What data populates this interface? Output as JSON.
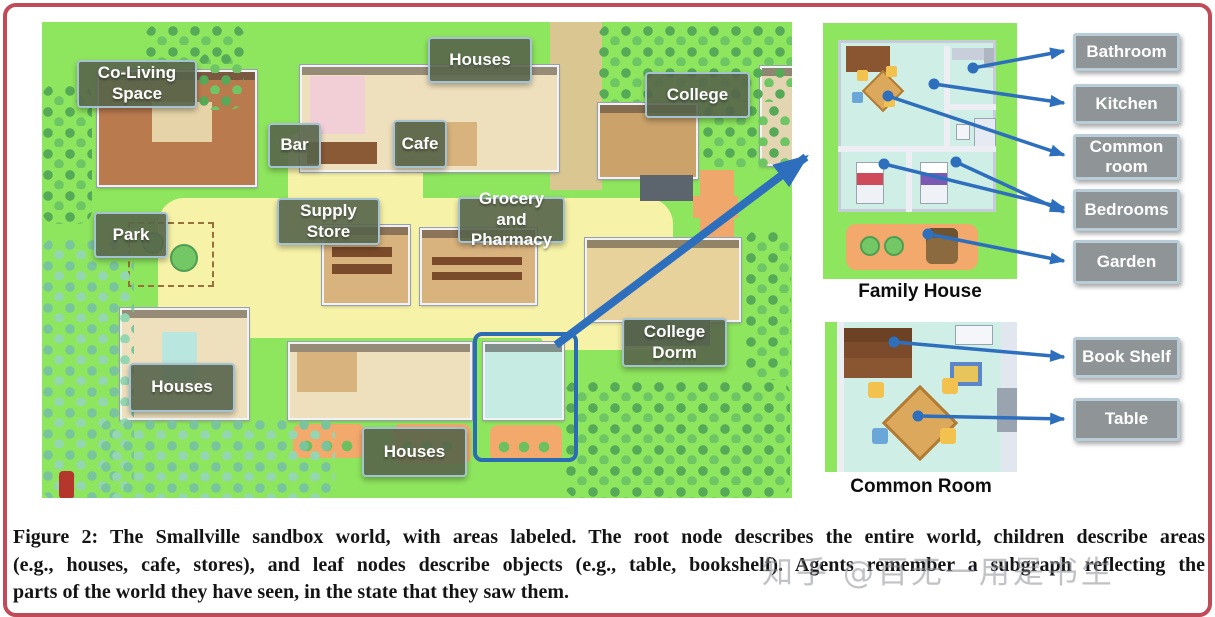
{
  "figure": {
    "caption_lines": [
      "Figure 2: The Smallville sandbox world, with areas labeled. The root node describes the entire world, children describe areas",
      "(e.g., houses, cafe, stores), and leaf nodes describe objects (e.g., table, bookshelf). Agents remember a subgraph reflecting the",
      "parts of the world they have seen, in the state that they saw them."
    ],
    "watermark": "知乎 @百无一用是书生"
  },
  "map": {
    "labels": [
      {
        "id": "co-living-space",
        "text": "Co-Living Space"
      },
      {
        "id": "houses-top",
        "text": "Houses"
      },
      {
        "id": "bar",
        "text": "Bar"
      },
      {
        "id": "cafe",
        "text": "Cafe"
      },
      {
        "id": "college",
        "text": "College"
      },
      {
        "id": "park",
        "text": "Park"
      },
      {
        "id": "supply-store",
        "text": "Supply Store"
      },
      {
        "id": "grocery-pharmacy",
        "text": "Grocery and Pharmacy"
      },
      {
        "id": "college-dorm",
        "text": "College Dorm"
      },
      {
        "id": "houses-left",
        "text": "Houses"
      },
      {
        "id": "houses-bottom",
        "text": "Houses"
      }
    ]
  },
  "panels": {
    "family_house": {
      "caption": "Family House",
      "labels": [
        "Bathroom",
        "Kitchen",
        "Common room",
        "Bedrooms",
        "Garden"
      ]
    },
    "common_room": {
      "caption": "Common Room",
      "labels": [
        "Book Shelf",
        "Table"
      ]
    }
  },
  "colors": {
    "frame_red": "#c04a57",
    "arrow_blue": "#2e6fbd",
    "map_label_bg": "#56644a",
    "side_label_bg": "#8f9496",
    "map_green": "#8ee55e",
    "path_yellow": "#f6f2a8",
    "highlight_blue": "#2c6cb5"
  }
}
